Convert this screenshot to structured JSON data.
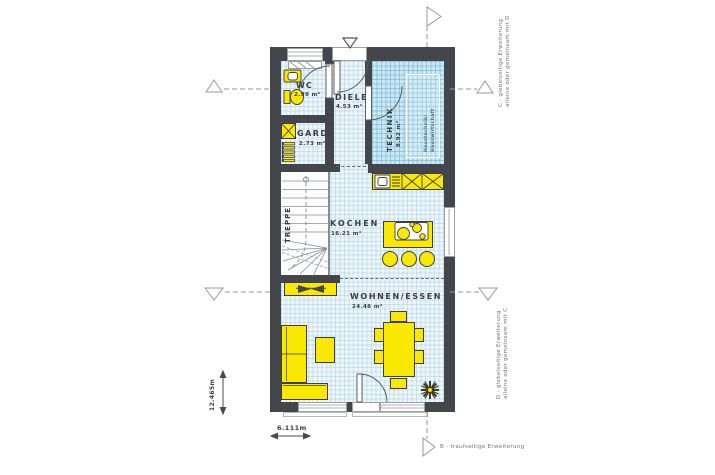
{
  "rooms": {
    "wc": {
      "name": "WC",
      "area": "2.99 m²"
    },
    "diele": {
      "name": "DIELE",
      "area": "4.53 m²"
    },
    "gard": {
      "name": "GARD.",
      "area": "2.73 m²"
    },
    "technik": {
      "name": "TECHNIK",
      "area": "8.92 m²",
      "sub_line1": "Haustechnik/",
      "sub_line2": "Hauswirtschaft"
    },
    "treppe": {
      "name": "TREPPE"
    },
    "kochen": {
      "name": "KOCHEN",
      "area": "16.21 m²"
    },
    "wohnen_essen": {
      "name": "WOHNEN/ESSEN",
      "area": "24.48 m²"
    }
  },
  "dimensions": {
    "total_depth": "12.465m",
    "total_width": "6.111m"
  },
  "expansion_notes": {
    "c_line1": "C - giebelseitige Erweiterung",
    "c_line2": "alleine oder gemeinsam mit D",
    "d_line1": "D - giebelseitige Erweiterung",
    "d_line2": "alleine oder gemeinsam mit C",
    "b": "B - traufseitige Erweiterung"
  },
  "colors": {
    "wall": "#43464a",
    "furniture_yellow": "#f9e800",
    "technik_floor": "#c7e8f4",
    "floor": "#ecf5fa",
    "outline": "#3e3e3e"
  }
}
